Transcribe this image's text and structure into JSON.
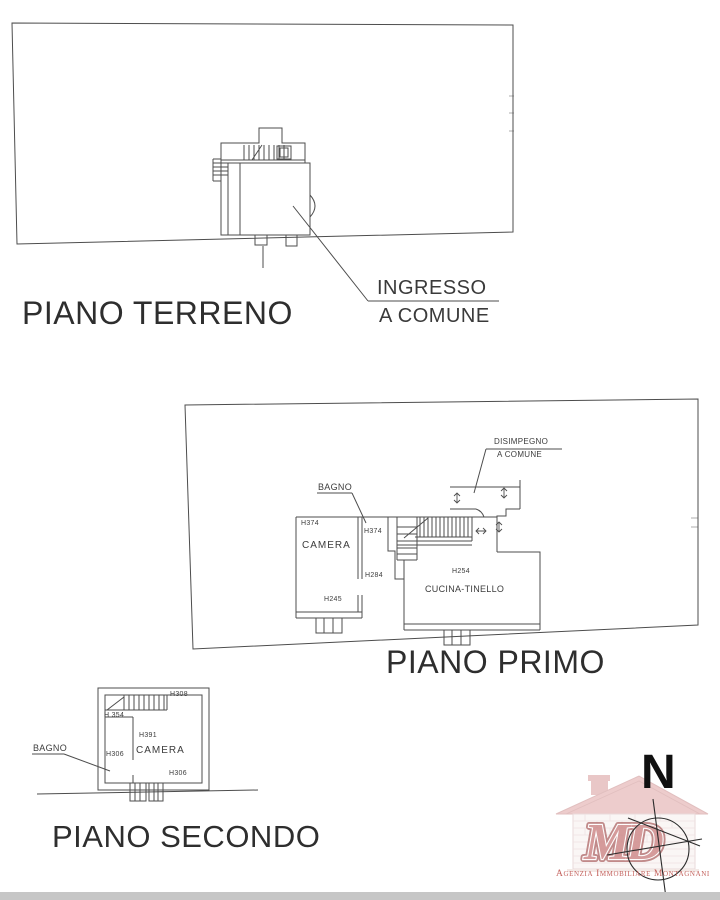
{
  "titles": {
    "ground_floor": "PIANO TERRENO",
    "first_floor": "PIANO PRIMO",
    "second_floor": "PIANO SECONDO"
  },
  "ground_floor": {
    "annotation_line1": "INGRESSO",
    "annotation_line2": "A COMUNE"
  },
  "first_floor": {
    "annotation_line1": "DISIMPEGNO",
    "annotation_line2": "A COMUNE",
    "room_bagno": "BAGNO",
    "room_camera": "CAMERA",
    "room_cucina": "CUCINA-TINELLO",
    "h_camera": "H374",
    "h_bagno": "H374",
    "h_284": "H284",
    "h_245": "H245",
    "h_cucina": "H254"
  },
  "second_floor": {
    "room_bagno": "BAGNO",
    "room_camera": "CAMERA",
    "h_top_right": "H308",
    "h_stair": "H 354",
    "h_camera": "H391",
    "h_bagno": "H306",
    "h_bottom_right": "H306"
  },
  "compass": {
    "north": "N"
  },
  "logo": {
    "monogram": "MD",
    "agency": "Agenzia Immobiliare Montagnani"
  },
  "colors": {
    "linework": "#4d4d4d",
    "text": "#2e2e2e",
    "logo_red": "#c0504d",
    "logo_pink": "#dfa3a3"
  }
}
